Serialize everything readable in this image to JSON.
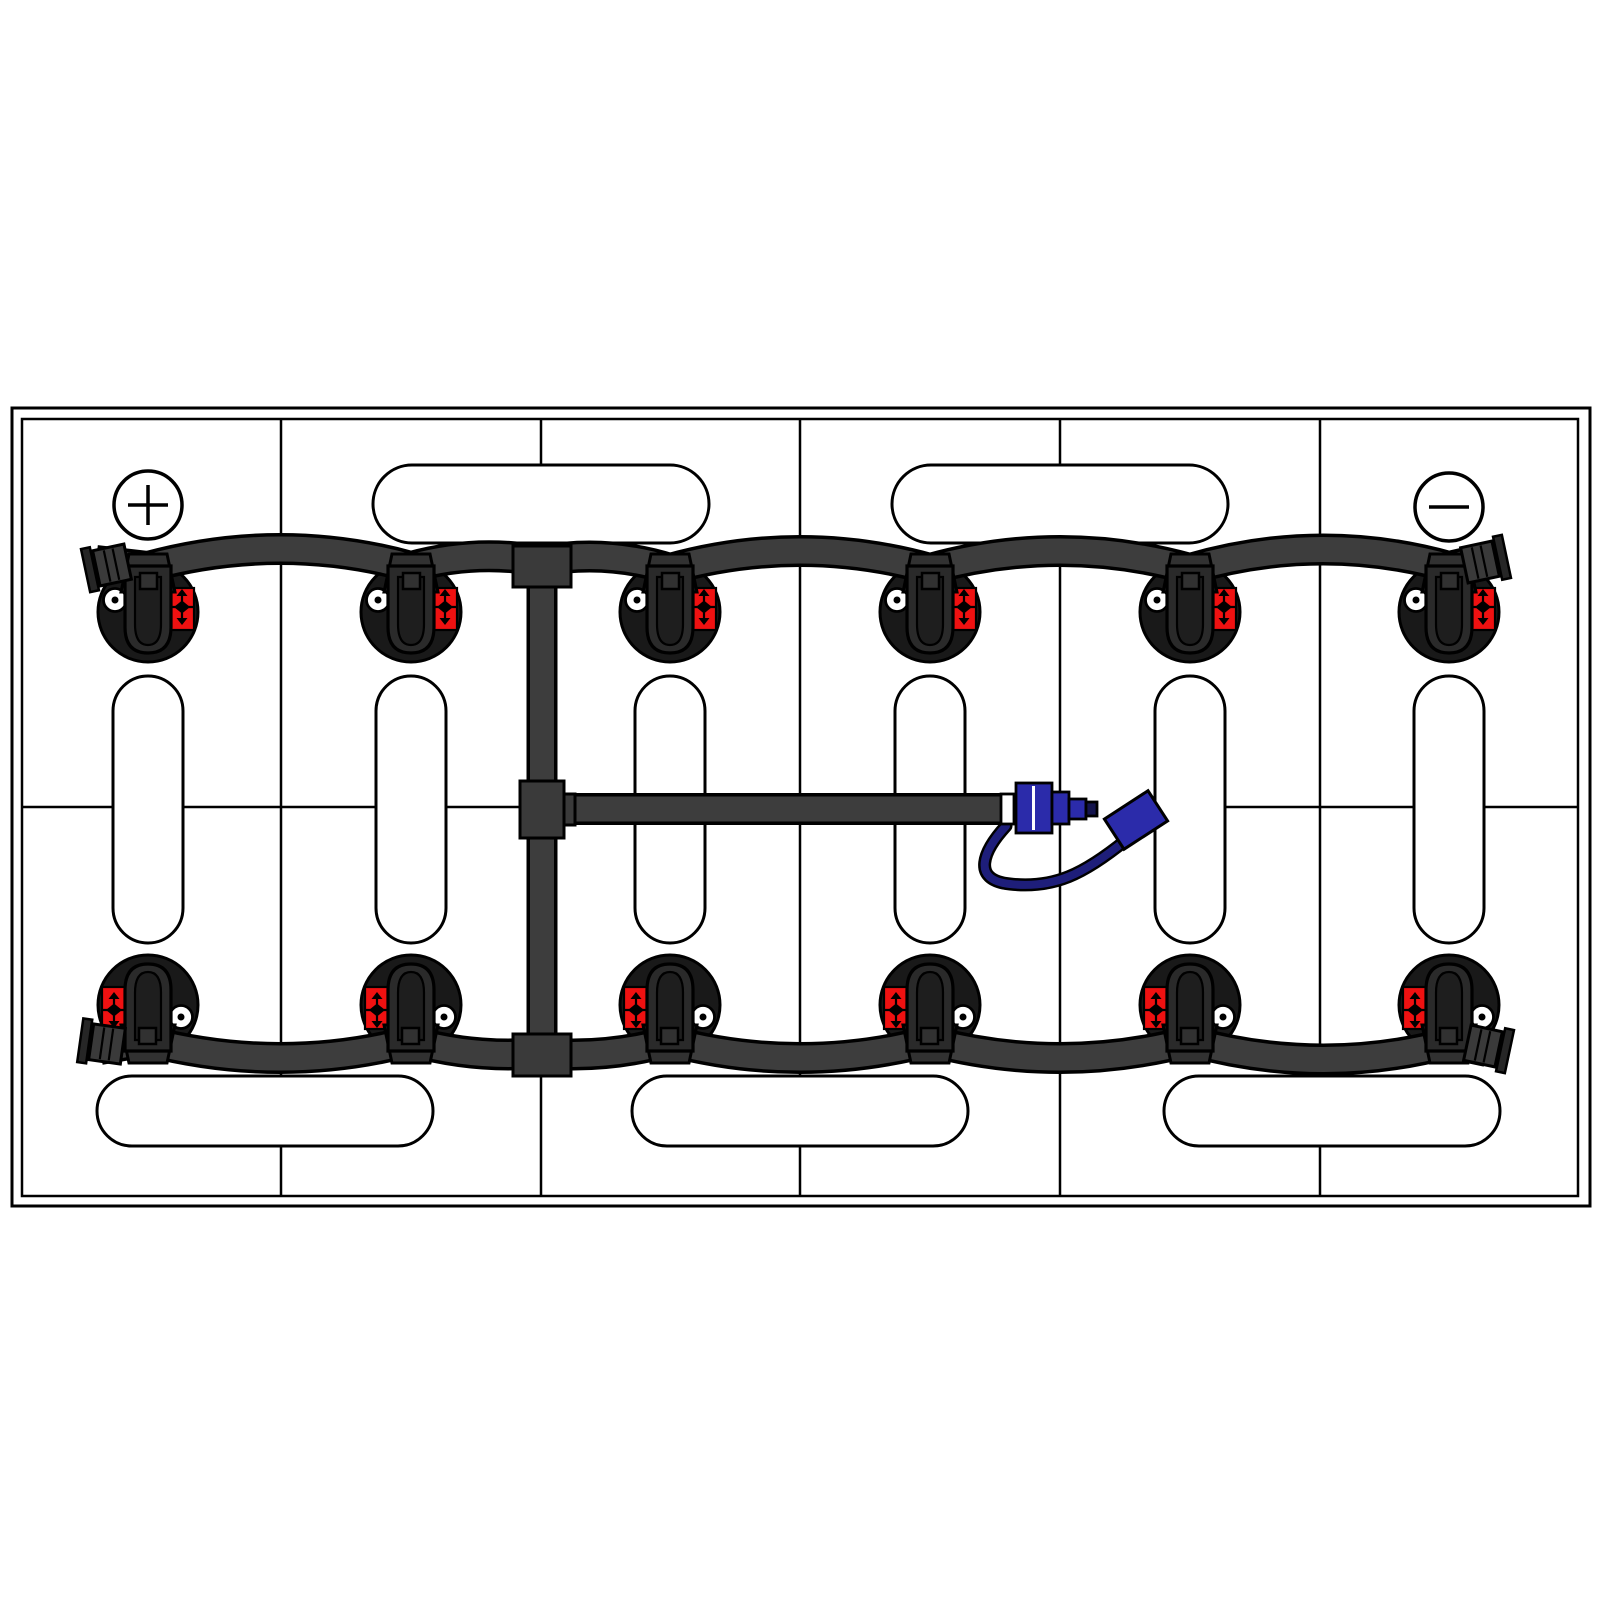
{
  "title": "Battery watering system diagram - 12-cell battery top view with single point watering kit",
  "colors": {
    "background": "#ffffff",
    "outline": "#000000",
    "tube": "#3d3d3d",
    "fitting": "#3a3a3a",
    "cap_circle": "#191919",
    "cap_body": "#2a2a2a",
    "cap_inner": "#1e1e1e",
    "cap_lid": "#313131",
    "plug_block": "#3a3a3a",
    "plug_plate": "#262626",
    "label_red": "#ef1111",
    "coupler_blue": "#2b2baa",
    "coupler_tip": "#14144d",
    "cord_navy": "#1e1e7a",
    "white": "#ffffff"
  },
  "frame": {
    "outer": [
      12,
      408,
      1578,
      798
    ],
    "inner": [
      22,
      419,
      1556,
      777
    ]
  },
  "grid": {
    "column_lines_x": [
      281,
      541,
      800,
      1060,
      1320
    ],
    "top_y": 419,
    "bottom_y": 1195,
    "row_line_y": 807,
    "row_line_segments": [
      [
        22,
        1048
      ],
      [
        1162,
        1578
      ]
    ],
    "cell_columns": 6,
    "cell_rows": 2
  },
  "terminals": [
    {
      "name": "positive-terminal",
      "symbol": "+",
      "x": 148,
      "y": 505,
      "r": 34
    },
    {
      "name": "negative-terminal",
      "symbol": "-",
      "x": 1449,
      "y": 507,
      "r": 34
    }
  ],
  "pills": {
    "top": [
      [
        373,
        465,
        336,
        78
      ],
      [
        892,
        465,
        336,
        78
      ]
    ],
    "middle_vertical_y": 676,
    "middle_vertical_h": 267,
    "middle_vertical_w": 70,
    "bottom": [
      [
        97,
        1076,
        336,
        70
      ],
      [
        632,
        1076,
        336,
        70
      ],
      [
        1164,
        1076,
        336,
        70
      ]
    ]
  },
  "caps": {
    "columns_x": [
      148,
      411,
      670,
      930,
      1190,
      1449
    ],
    "top_row_cy": 612,
    "rotation_cy": 808.5,
    "circle_r": 50,
    "dot_dx": -33,
    "dot_dy": -12,
    "dot_r": 11.5,
    "label_rect_d": [
      22,
      -24,
      24,
      42
    ],
    "count_top": 6,
    "count_bottom": 6
  },
  "tubes": {
    "top_manifold": "M 96 561 L 148 567 Q 281 531 411 567 Q 476 549 541 561 Q 606 549 670 569 Q 800 533 930 569 Q 1060 533 1190 569 Q 1320 531 1449 567 L 1484 559",
    "bottom_manifold": "M 100 1049 L 148 1041 Q 281 1075 411 1041 Q 476 1059 541 1053 Q 606 1059 670 1041 Q 800 1075 930 1041 Q 1060 1075 1190 1041 Q 1320 1077 1449 1043 L 1487 1051",
    "vertical_feed": "M 542 559 L 542 1056",
    "branch_feed": "M 541 809 L 1003 809",
    "outline_w": 32,
    "fill_w": 25
  },
  "fittings": [
    {
      "name": "tee-fitting-top",
      "rect": [
        513,
        546,
        58,
        41
      ]
    },
    {
      "name": "cross-fitting",
      "rect": [
        520,
        781,
        44,
        57
      ]
    },
    {
      "name": "cross-fitting-collar",
      "rect": [
        564,
        794,
        11,
        31
      ]
    },
    {
      "name": "tee-fitting-bottom",
      "rect": [
        513,
        1034,
        58,
        42
      ]
    }
  ],
  "end_plugs": [
    {
      "name": "tube-end-plug-top-left",
      "x": 112,
      "y": 565,
      "angle": -12,
      "side": -1
    },
    {
      "name": "tube-end-plug-top-right",
      "x": 1480,
      "y": 562,
      "angle": -12,
      "side": 1
    },
    {
      "name": "tube-end-plug-bottom-left",
      "x": 107,
      "y": 1044,
      "angle": 8,
      "side": -1
    },
    {
      "name": "tube-end-plug-bottom-right",
      "x": 1483,
      "y": 1046,
      "angle": 12,
      "side": 1
    }
  ],
  "coupler": {
    "cord_path": "M 1006 826 C 984 850 970 880 1010 884 C 1054 889 1084 874 1126 840",
    "parts": [
      {
        "name": "coupler-collar",
        "rect": [
          1001,
          794,
          13,
          30
        ],
        "fill": "white"
      },
      {
        "name": "coupler-body",
        "rect": [
          1016,
          783,
          36,
          50
        ],
        "fill": "coupler_blue"
      },
      {
        "name": "coupler-step-1",
        "rect": [
          1052,
          792,
          17,
          32
        ],
        "fill": "coupler_blue"
      },
      {
        "name": "coupler-step-2",
        "rect": [
          1069,
          799,
          17,
          20
        ],
        "fill": "coupler_blue"
      },
      {
        "name": "coupler-nipple",
        "rect": [
          1086,
          802,
          11,
          14
        ],
        "fill": "coupler_tip"
      }
    ],
    "body_divider_x": 1033.5,
    "dust_cap": {
      "cx": 1136,
      "cy": 820,
      "w": 52,
      "h": 36,
      "angle": -33
    }
  }
}
